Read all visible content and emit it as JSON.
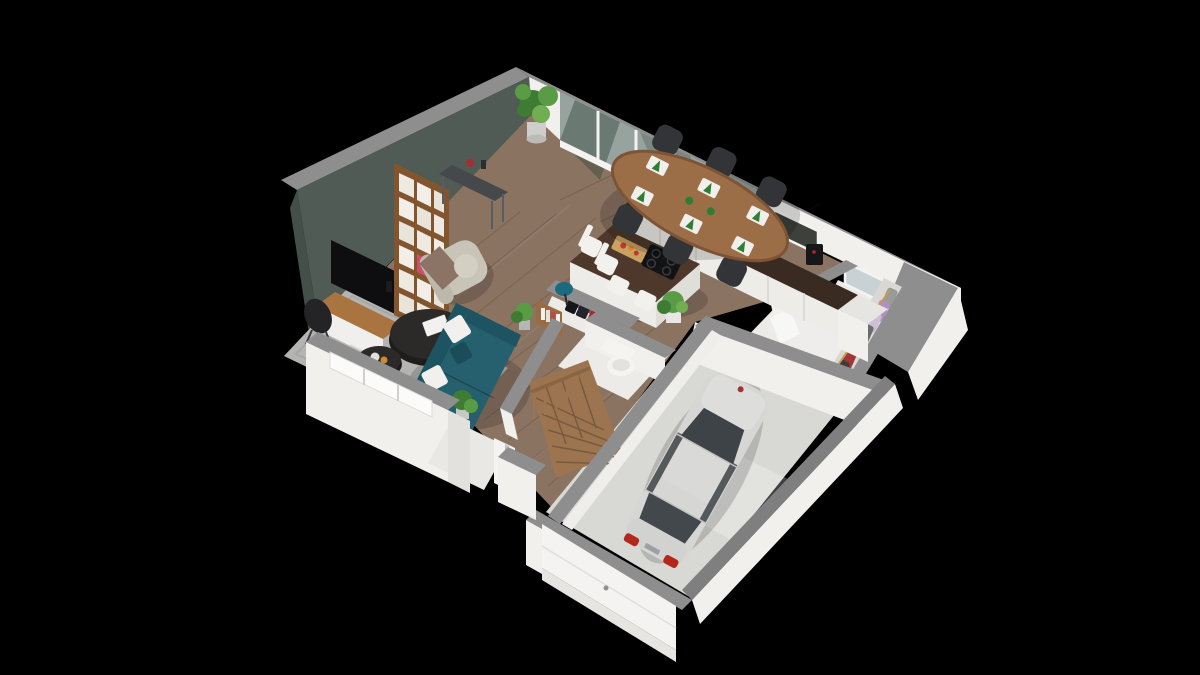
{
  "scene": {
    "type": "3d-floor-plan-render",
    "view": "isometric-dollhouse-cutaway",
    "background": "#000000",
    "floor": "ground-floor"
  },
  "palette": {
    "wall_cap": "#8e8e8e",
    "wall_white": "#f1f0ed",
    "accent_wall": "#4f5b54",
    "wood_floor": "#8b7362",
    "garage_floor": "#d8d8d5",
    "white_floor": "#ecebe8",
    "rug": "#b4b5b2",
    "sofa": "#26606e",
    "sofa_dark": "#1e5362",
    "armchair": "#c8c4b7",
    "blanket": "#8b7365",
    "coffee_table": "#2b2a28",
    "tv": "#0e0e10",
    "tv_unit_wood": "#a9743f",
    "bookshelf_wood": "#82552f",
    "console": "#46494c",
    "dining_table": "#9c6e47",
    "chair": "#323438",
    "island_top": "#4e382c",
    "counter_top": "#3a2b22",
    "cabinet_white": "#edece8",
    "stairs_wood": "#9c7450",
    "toilet": "#f5f4f2",
    "water_heater": "#eeedeb",
    "plant_green": "#5a9b45",
    "car_body": "#d6d6d4",
    "car_glass": "#3e4347",
    "taillight": "#b3281b",
    "glass_window": "#97a39f",
    "door_white": "#f4f3f1",
    "hanger_gold": "#c29c55",
    "napkin_green": "#2e7d32"
  },
  "rooms": [
    {
      "id": "living-room"
    },
    {
      "id": "dining-area"
    },
    {
      "id": "kitchen"
    },
    {
      "id": "entry-hall"
    },
    {
      "id": "wc"
    },
    {
      "id": "utility-room"
    },
    {
      "id": "dressing-closet"
    },
    {
      "id": "garage"
    }
  ],
  "objects": [
    "tv",
    "tv-unit",
    "bookshelf",
    "console-table",
    "armchair",
    "sofa",
    "coffee-tables",
    "rug",
    "dining-table",
    "dining-chairs",
    "kitchen-island",
    "cooktop",
    "bar-stools",
    "kitchen-counter",
    "sink",
    "coffee-machine",
    "water-heater",
    "clothes-rail",
    "coat-closet",
    "toilet",
    "staircase",
    "car",
    "garage-door",
    "front-door",
    "plants",
    "floor-lamp",
    "glass-doors"
  ]
}
